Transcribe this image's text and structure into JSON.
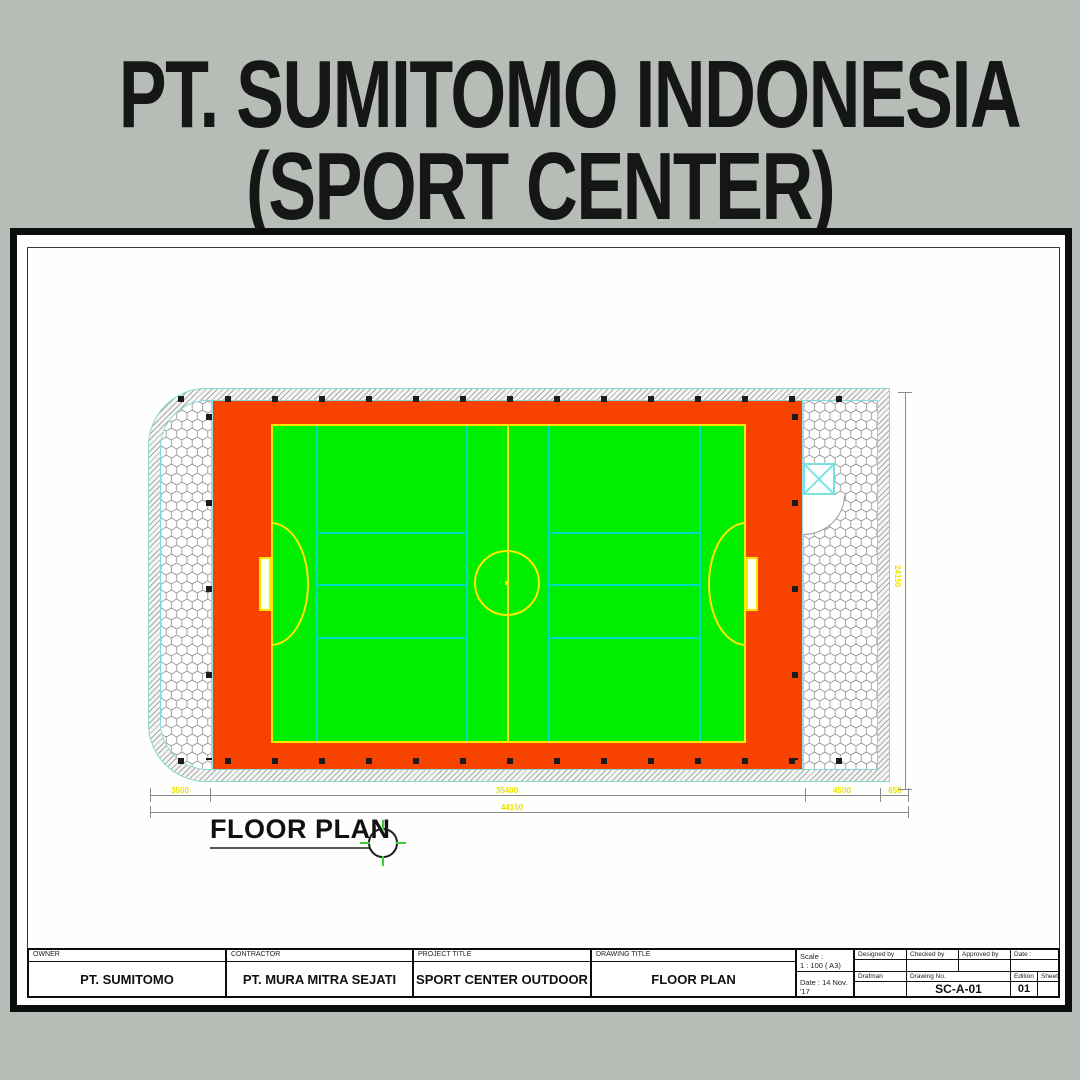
{
  "header": {
    "title_line1": "PT. SUMITOMO INDONESIA",
    "title_line2": "(SPORT CENTER)"
  },
  "plan": {
    "caption": "FLOOR PLAN",
    "dimensions": {
      "segment_left": "3500",
      "segment_middle": "35400",
      "segment_right": "4500",
      "segment_edge": "650",
      "total_bottom": "44150",
      "right_vertical": "24150"
    }
  },
  "title_block": {
    "owner": {
      "label": "OWNER",
      "value": "PT. SUMITOMO"
    },
    "contractor": {
      "label": "CONTRACTOR",
      "value": "PT. MURA MITRA SEJATI"
    },
    "project_title": {
      "label": "PROJECT TITLE",
      "value": "SPORT CENTER OUTDOOR"
    },
    "drawing_title": {
      "label": "DRAWING TITLE",
      "value": "FLOOR PLAN"
    },
    "scale_label": "Scale :",
    "scale_value": "1 : 100 ( A3)",
    "date_label": "Date : 14 Nov. '17",
    "designed_by": {
      "label": "Designed by",
      "value": ""
    },
    "checked_by": {
      "label": "Checked by",
      "value": ""
    },
    "approved_by": {
      "label": "Approved by",
      "value": ""
    },
    "date_col": {
      "label": "Date :",
      "value": ""
    },
    "drafman": {
      "label": "Drafman",
      "value": ""
    },
    "drawing_no": {
      "label": "Drawing No.",
      "value": "SC-A-01"
    },
    "edition": {
      "label": "Edition",
      "value": "01"
    },
    "sheet": {
      "label": "Sheet",
      "value": ""
    }
  },
  "colors": {
    "background_gray": "#b6bdb7",
    "track_orange": "#f84300",
    "pitch_green": "#00ee00",
    "marking_yellow": "#ffe800",
    "court_cyan": "#00ddc6",
    "border_cyan": "#84d9d9",
    "dimension_yellow": "#ece400"
  }
}
